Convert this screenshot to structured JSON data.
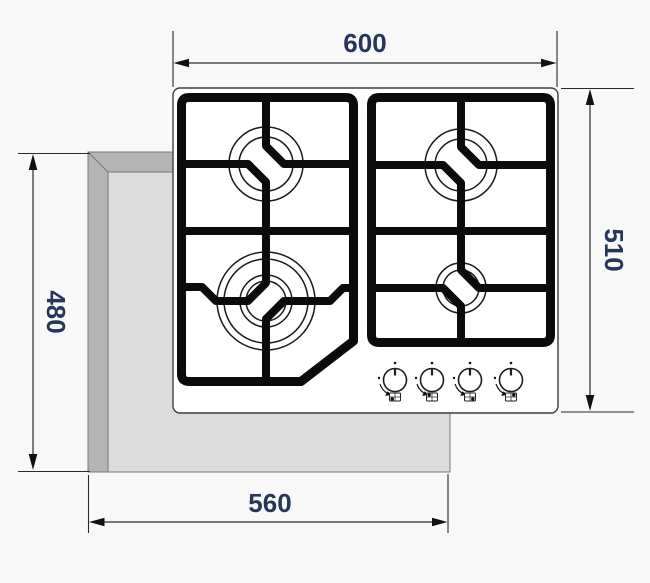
{
  "diagram": {
    "dimensions": {
      "top": "600",
      "right": "510",
      "left": "480",
      "bottom": "560"
    },
    "colors": {
      "background": "#f8f8f8",
      "dimension_text": "#26355a",
      "dimension_line": "#2a2a2a",
      "grate": "#0b0b0b",
      "hob_surface": "#ffffff",
      "countertop_edge": "#b4b4b4",
      "countertop_cutout": "#dcdcdc"
    },
    "counts": {
      "burners": 4,
      "control_knobs": 4
    }
  }
}
